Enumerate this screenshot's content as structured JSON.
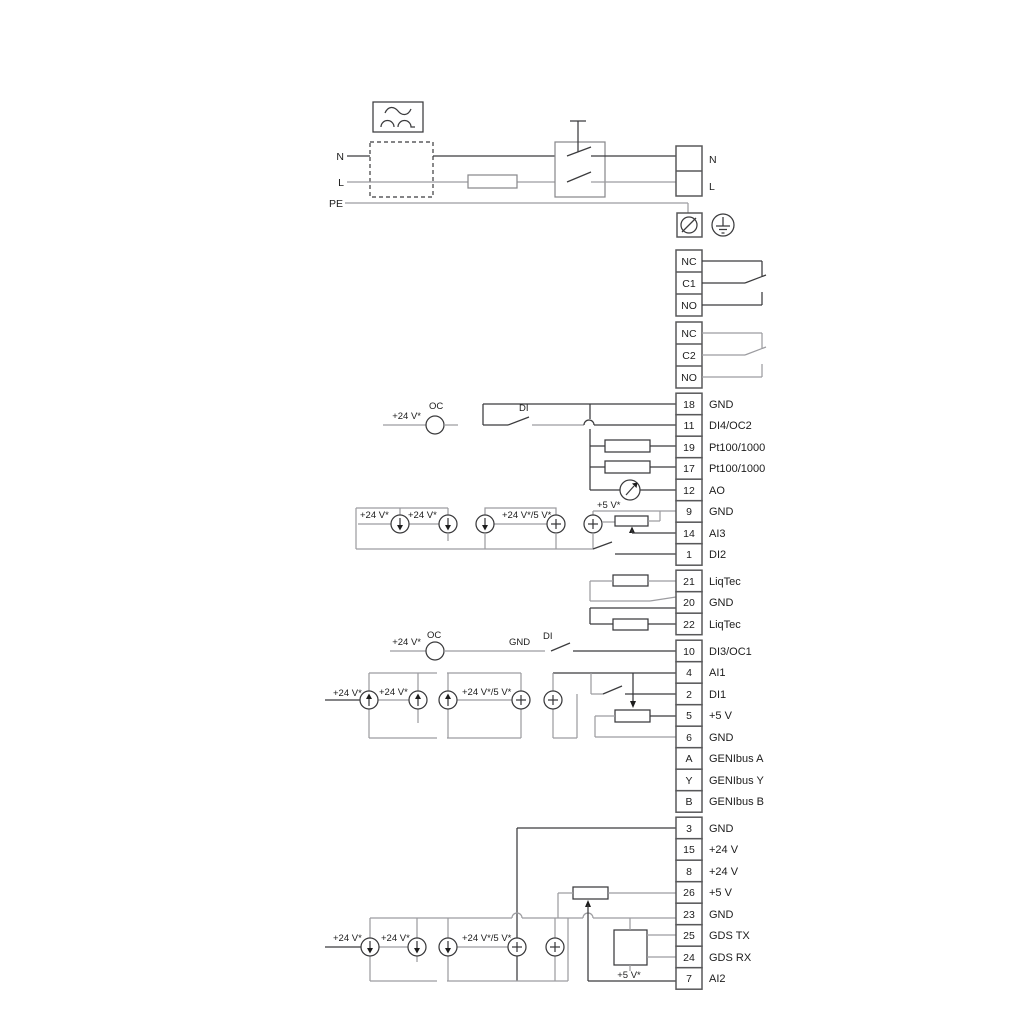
{
  "colors": {
    "line_dark": "#3b3b3d",
    "line_grey": "#9c9ca0",
    "text": "#1c1c1c",
    "background": "#ffffff"
  },
  "power": {
    "n_in": "N",
    "l_in": "L",
    "pe": "PE",
    "n_out": "N",
    "l_out": "L"
  },
  "relays": [
    {
      "cells": [
        "NC",
        "C1",
        "NO"
      ]
    },
    {
      "cells": [
        "NC",
        "C2",
        "NO"
      ]
    }
  ],
  "terminal_groups": [
    {
      "rows": [
        {
          "num": "18",
          "label": "GND"
        },
        {
          "num": "11",
          "label": "DI4/OC2"
        },
        {
          "num": "19",
          "label": "Pt100/1000"
        },
        {
          "num": "17",
          "label": "Pt100/1000"
        },
        {
          "num": "12",
          "label": "AO"
        },
        {
          "num": "9",
          "label": "GND"
        },
        {
          "num": "14",
          "label": "AI3"
        },
        {
          "num": "1",
          "label": "DI2"
        }
      ]
    },
    {
      "rows": [
        {
          "num": "21",
          "label": "LiqTec"
        },
        {
          "num": "20",
          "label": "GND"
        },
        {
          "num": "22",
          "label": "LiqTec"
        }
      ]
    },
    {
      "rows": [
        {
          "num": "10",
          "label": "DI3/OC1"
        },
        {
          "num": "4",
          "label": "AI1"
        },
        {
          "num": "2",
          "label": "DI1"
        },
        {
          "num": "5",
          "label": "+5 V"
        },
        {
          "num": "6",
          "label": "GND"
        },
        {
          "num": "A",
          "label": "GENIbus A"
        },
        {
          "num": "Y",
          "label": "GENIbus Y"
        },
        {
          "num": "B",
          "label": "GENIbus B"
        }
      ]
    },
    {
      "rows": [
        {
          "num": "3",
          "label": "GND"
        },
        {
          "num": "15",
          "label": "+24 V"
        },
        {
          "num": "8",
          "label": "+24 V"
        },
        {
          "num": "26",
          "label": "+5 V"
        },
        {
          "num": "23",
          "label": "GND"
        },
        {
          "num": "25",
          "label": "GDS TX"
        },
        {
          "num": "24",
          "label": "GDS RX"
        },
        {
          "num": "7",
          "label": "AI2"
        }
      ]
    }
  ],
  "wire_labels": {
    "oc1_v24": "+24 V*",
    "oc1": "OC",
    "di4": "DI",
    "r1_v24a": "+24 V*",
    "r1_v24b": "+24 V*",
    "r1_v24_5": "+24 V*/5 V*",
    "r1_v5": "+5 V*",
    "oc2_v24": "+24 V*",
    "oc2": "OC",
    "oc2_gnd": "GND",
    "di3": "DI",
    "r2_v24a": "+24 V*",
    "r2_v24b": "+24 V*",
    "r2_v24_5": "+24 V*/5 V*",
    "r3_v24a": "+24 V*",
    "r3_v24b": "+24 V*",
    "r3_v24_5": "+24 V*/5 V*",
    "r3_v5": "+5 V*"
  }
}
